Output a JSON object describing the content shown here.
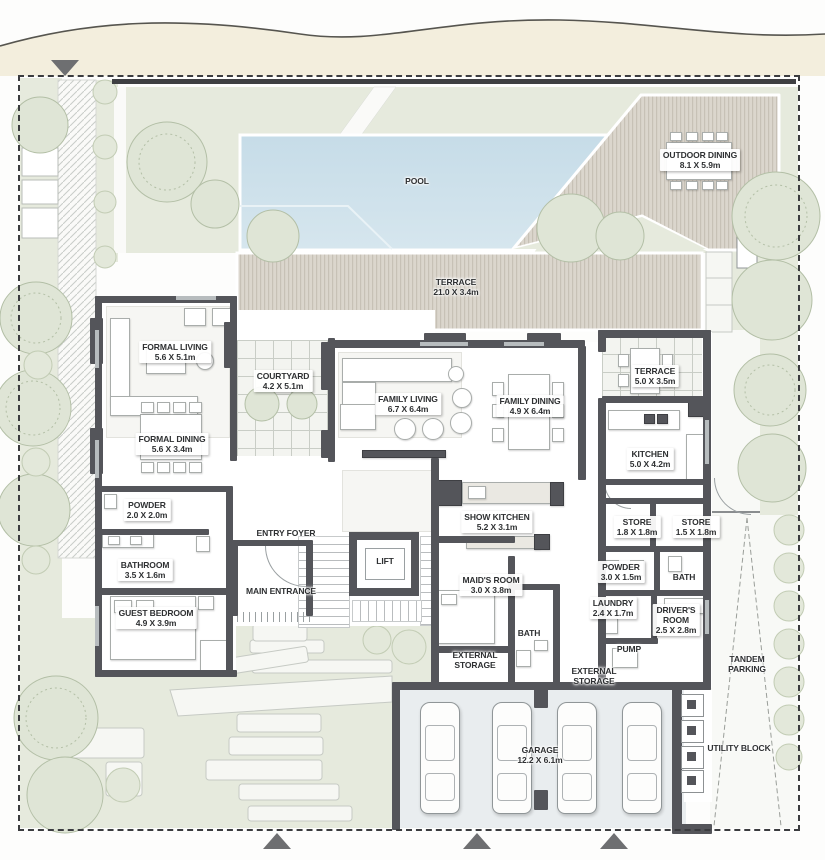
{
  "plan_type": "ground-floor-site-plan",
  "colors": {
    "wall": "#54555a",
    "water": "#cbdfe9",
    "lawn": "#e6eadd",
    "tree": "#dfe5d6",
    "deck": "#dbd6cd",
    "deck_stripe": "#c7c1b6",
    "road_band": "#f3eedd",
    "floor": "#ffffff",
    "garage_floor": "#e9edef",
    "label_text": "#2e3032",
    "boundary": "#3b3c3f"
  },
  "labels": {
    "pool": [
      "POOL"
    ],
    "outdoor_dining": [
      "OUTDOOR DINING",
      "8.1 X 5.9m"
    ],
    "terrace_main": [
      "TERRACE",
      "21.0 X 3.4m"
    ],
    "formal_living": [
      "FORMAL LIVING",
      "5.6 X 5.1m"
    ],
    "courtyard": [
      "COURTYARD",
      "4.2 X 5.1m"
    ],
    "family_living": [
      "FAMILY LIVING",
      "6.7 X 6.4m"
    ],
    "family_dining": [
      "FAMILY DINING",
      "4.9 X 6.4m"
    ],
    "terrace_small": [
      "TERRACE",
      "5.0 X 3.5m"
    ],
    "formal_dining": [
      "FORMAL DINING",
      "5.6 X 3.4m"
    ],
    "kitchen": [
      "KITCHEN",
      "5.0 X 4.2m"
    ],
    "powder_1": [
      "POWDER",
      "2.0 X 2.0m"
    ],
    "show_kitchen": [
      "SHOW KITCHEN",
      "5.2 X 3.1m"
    ],
    "store_1": [
      "STORE",
      "1.8 X 1.8m"
    ],
    "store_2": [
      "STORE",
      "1.5 X 1.8m"
    ],
    "entry_foyer": [
      "ENTRY FOYER"
    ],
    "lift": [
      "LIFT"
    ],
    "bathroom": [
      "BATHROOM",
      "3.5 X 1.6m"
    ],
    "maids_room": [
      "MAID'S ROOM",
      "3.0 X 3.8m"
    ],
    "powder_2": [
      "POWDER",
      "3.0 X 1.5m"
    ],
    "bath_2": [
      "BATH"
    ],
    "main_entrance": [
      "MAIN ENTRANCE"
    ],
    "guest_bedroom": [
      "GUEST BEDROOM",
      "4.9 X 3.9m"
    ],
    "laundry": [
      "LAUNDRY",
      "2.4 X 1.7m"
    ],
    "drivers_room": [
      "DRIVER'S",
      "ROOM",
      "2.5 X 2.8m"
    ],
    "bath_1": [
      "BATH"
    ],
    "external_storage_1": [
      "EXTERNAL",
      "STORAGE"
    ],
    "pump": [
      "PUMP"
    ],
    "external_storage_2": [
      "EXTERNAL",
      "STORAGE"
    ],
    "tandem_parking": [
      "TANDEM",
      "PARKING"
    ],
    "garage": [
      "GARAGE",
      "12.2 X 6.1m"
    ],
    "utility_block": [
      "UTILITY BLOCK"
    ]
  }
}
